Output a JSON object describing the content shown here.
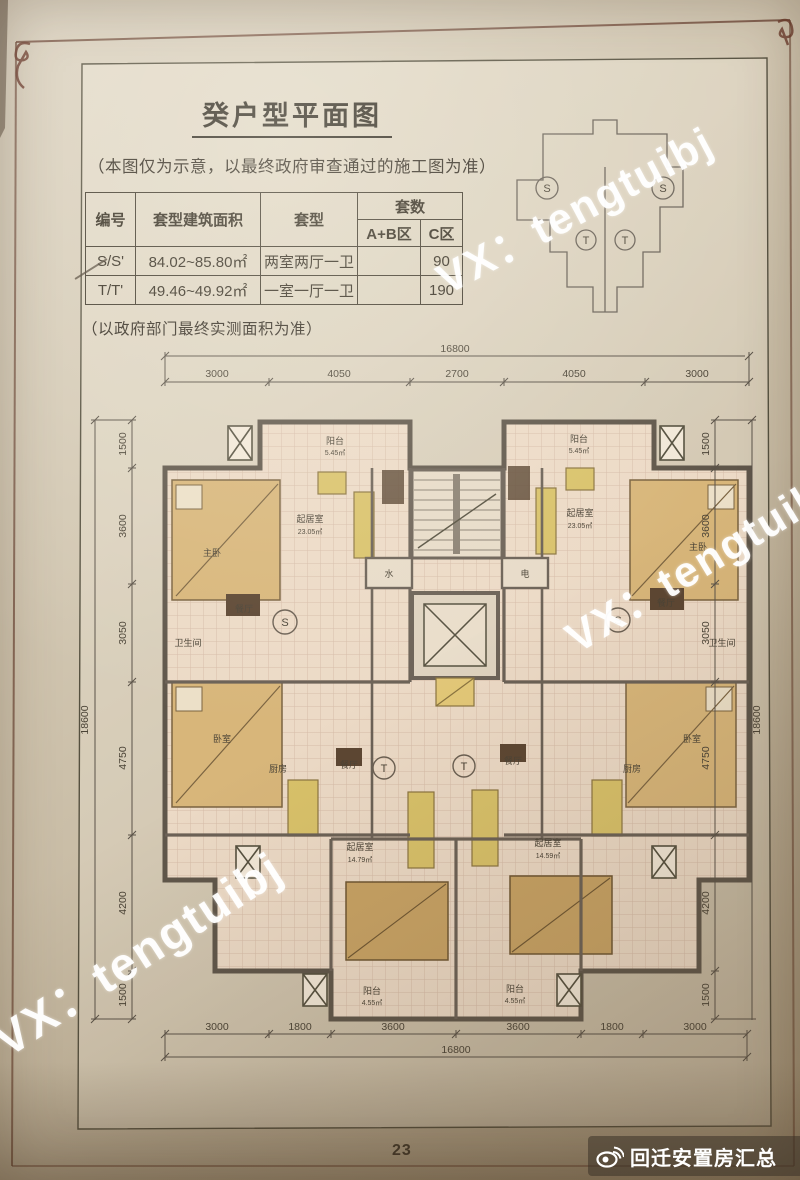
{
  "title": "癸户型平面图",
  "subtitle": "（本图仅为示意，以最终政府审查通过的施工图为准）",
  "footnote": "（以政府部门最终实测面积为准）",
  "watermark": {
    "text": "VX：tengtuibj"
  },
  "badge": {
    "label": "回迁安置房汇总"
  },
  "page_number": "23",
  "table": {
    "headers": {
      "id": "编号",
      "area": "套型建筑面积",
      "layout": "套型",
      "count": "套数",
      "count_ab": "A+B区",
      "count_c": "C区"
    },
    "rows": [
      {
        "id": "S/S'",
        "area": "84.02~85.80㎡",
        "layout": "两室两厅一卫",
        "count_ab": "",
        "count_c": "90"
      },
      {
        "id": "T/T'",
        "area": "49.46~49.92㎡",
        "layout": "一室一厅一卫",
        "count_ab": "",
        "count_c": "190"
      }
    ]
  },
  "keyplan": {
    "unit_s": "S",
    "unit_t": "T"
  },
  "plan": {
    "units": {
      "s": "S",
      "t": "T"
    },
    "dims": {
      "top_total": "16800",
      "top": [
        "3000",
        "4050",
        "2700",
        "4050",
        "3000"
      ],
      "bottom": [
        "3000",
        "1800",
        "3600",
        "3600",
        "1800",
        "3000"
      ],
      "bottom_total": "16800",
      "side": [
        "1500",
        "3600",
        "3050",
        "4750",
        "4200",
        "1500"
      ],
      "side_total": "18600"
    },
    "rooms": {
      "balcony": "阳台",
      "living": "起居室",
      "master": "主卧",
      "bedroom": "卧室",
      "dining": "餐厅",
      "kitchen": "厨房",
      "bath": "卫生间",
      "water": "水",
      "electric": "电"
    },
    "areas": {
      "balcony_top": "5.45㎡",
      "living_top": "23.05㎡",
      "living_bottom_left": "14.79㎡",
      "living_bottom_right": "14.59㎡",
      "balcony_bottom": "4.55㎡"
    }
  }
}
